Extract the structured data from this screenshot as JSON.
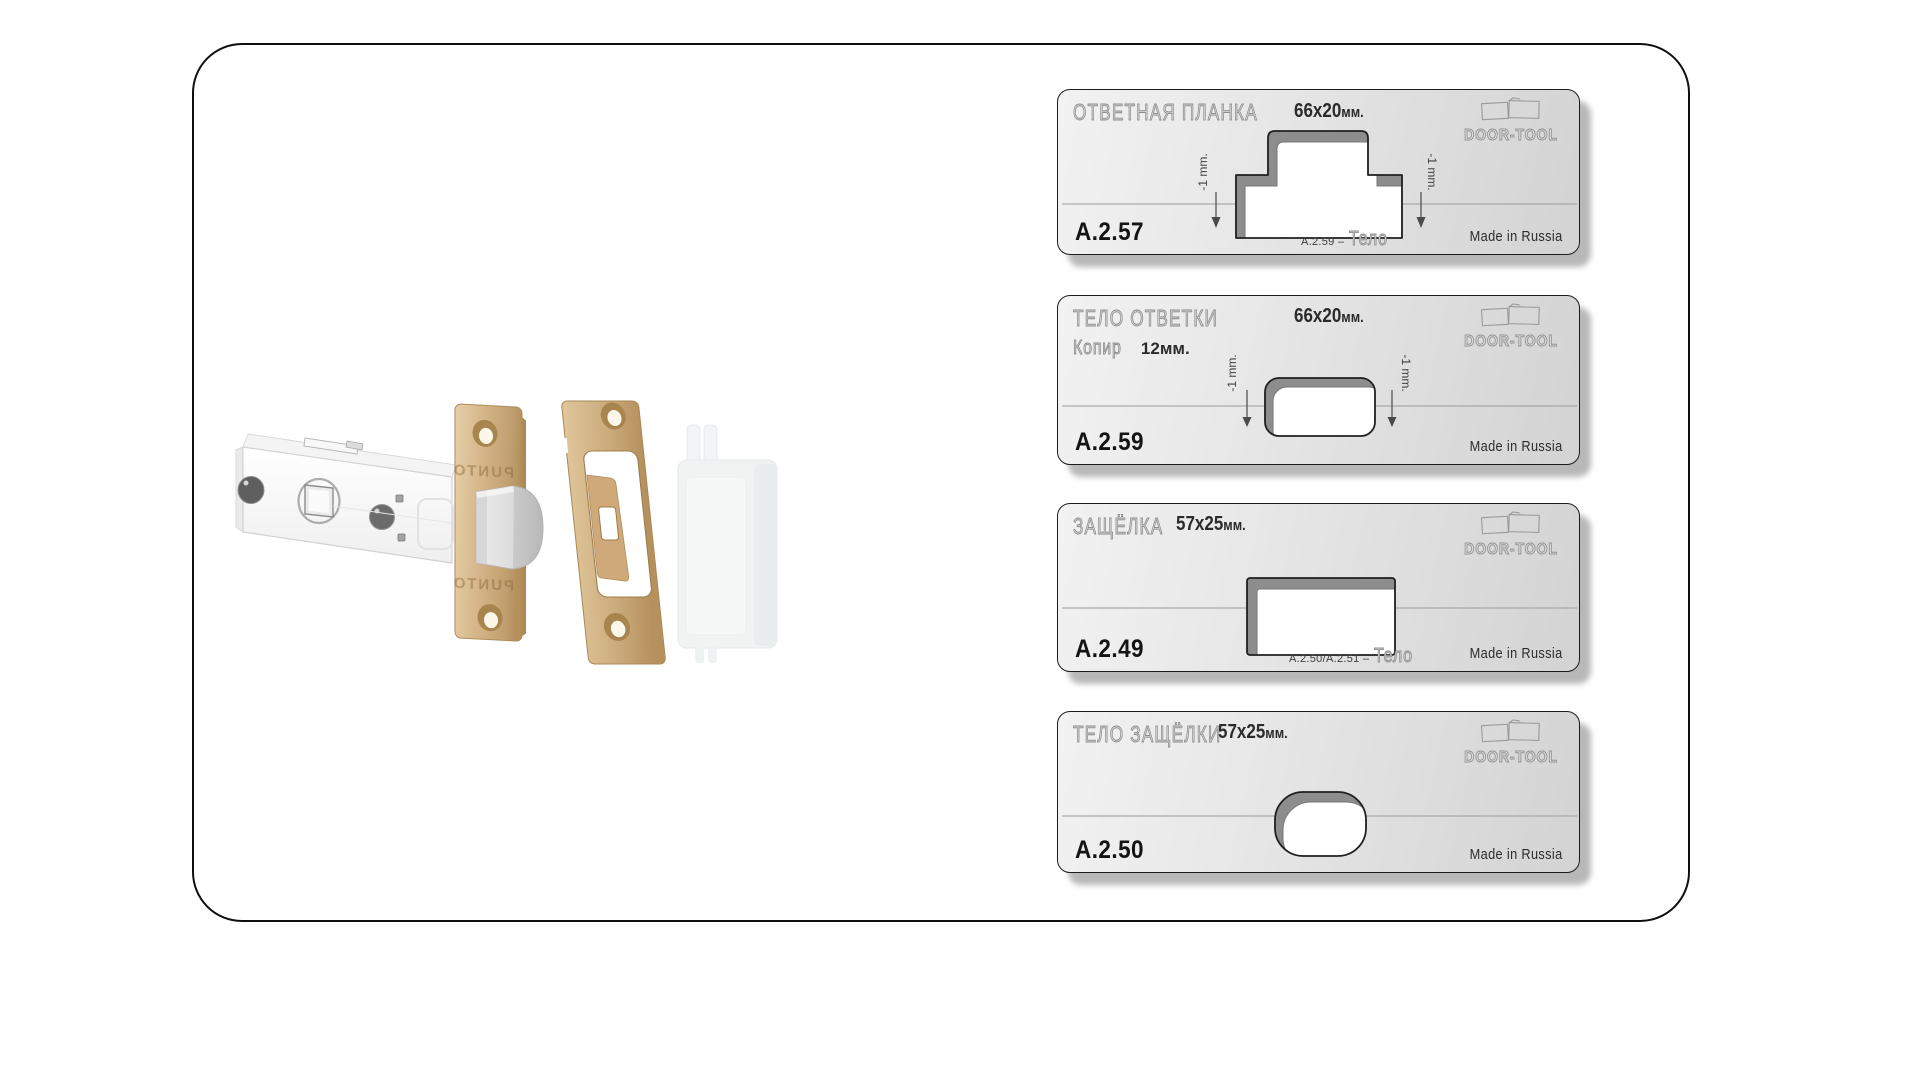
{
  "brand": {
    "name": "DOOR-TOOL"
  },
  "latch_illustration": {
    "engraving_top": "PUNTO",
    "engraving_bottom": "PUNTO"
  },
  "colors": {
    "bronze": "#d4b488",
    "plate_gray_light": "#f2f2f2",
    "plate_gray_dark": "#d3d3d3",
    "cutout_wall": "#8d8d8d",
    "engraving_stroke": "#8c8c8c"
  },
  "templates": [
    {
      "id": "A.2.57",
      "title": "ОТВЕТНАЯ ПЛАНКА",
      "size": "66x20",
      "size_unit": "мм.",
      "tol_left": "-1 mm.",
      "tol_right": "-1 mm.",
      "note_ref": "A.2.59 –",
      "note_word": "Тело",
      "made_in": "Made in Russia"
    },
    {
      "id": "A.2.59",
      "title": "ТЕЛО ОТВЕТКИ",
      "size": "66x20",
      "size_unit": "мм.",
      "sub_label": "Копир",
      "sub_value": "12мм.",
      "tol_left": "-1 mm.",
      "tol_right": "-1 mm.",
      "made_in": "Made in Russia"
    },
    {
      "id": "A.2.49",
      "title": "ЗАЩЁЛКА",
      "size": "57x25",
      "size_unit": "мм.",
      "note_ref": "A.2.50/A.2.51 –",
      "note_word": "Тело",
      "made_in": "Made in Russia"
    },
    {
      "id": "A.2.50",
      "title": "ТЕЛО ЗАЩЁЛКИ",
      "size": "57x25",
      "size_unit": "мм.",
      "made_in": "Made in Russia"
    }
  ]
}
